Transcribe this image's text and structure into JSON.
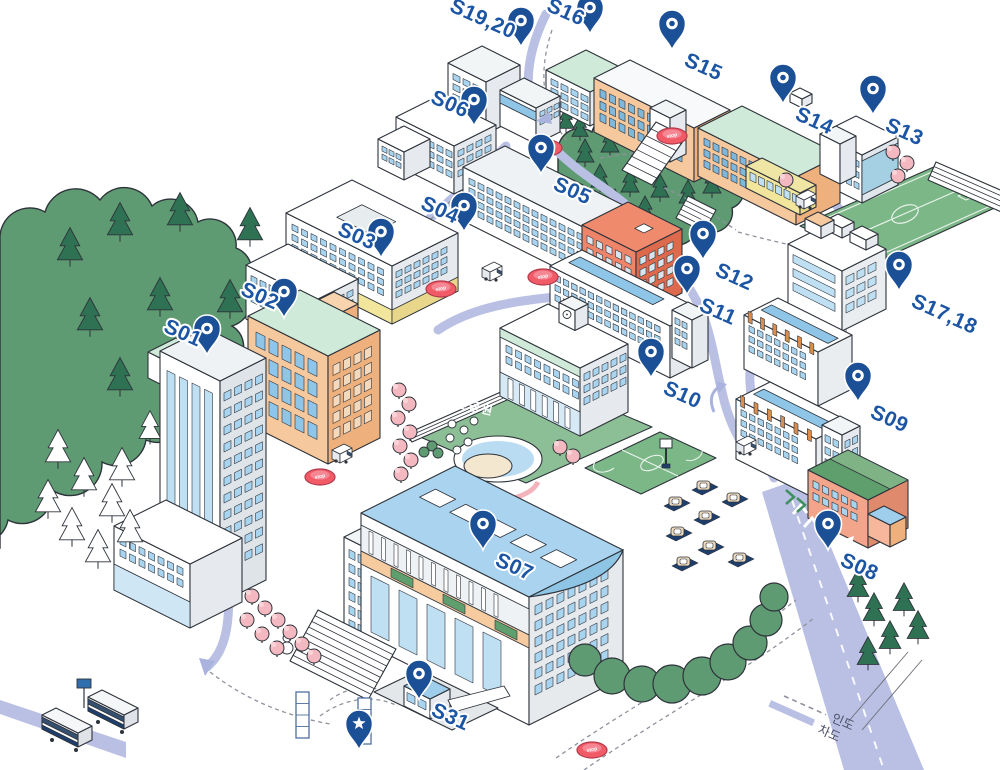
{
  "map": {
    "colors": {
      "pin": "#1b4f96",
      "label": "#1b55a4",
      "road": "#b9c0e4",
      "path": "#8d929c",
      "forest": "#5f9b72",
      "field": "#7cb788",
      "stop_disc": "#f15b67"
    },
    "legend": {
      "walkway_label": "인도",
      "roadway_label": "차도"
    },
    "park_label": "뉴턴공원",
    "stop_label": "stop",
    "markers": [
      {
        "id": "s01",
        "label": "S01",
        "x": 207,
        "y": 355,
        "side": "left"
      },
      {
        "id": "s02",
        "label": "S02",
        "x": 284,
        "y": 318,
        "side": "left"
      },
      {
        "id": "s03",
        "label": "S03",
        "x": 381,
        "y": 258,
        "side": "left"
      },
      {
        "id": "s04",
        "label": "S04",
        "x": 464,
        "y": 232,
        "side": "left"
      },
      {
        "id": "s05",
        "label": "S05",
        "x": 541,
        "y": 174,
        "side": "right"
      },
      {
        "id": "s06",
        "label": "S06",
        "x": 474,
        "y": 126,
        "side": "left"
      },
      {
        "id": "s07",
        "label": "S07",
        "x": 483,
        "y": 550,
        "side": "right"
      },
      {
        "id": "s08",
        "label": "S08",
        "x": 828,
        "y": 550,
        "side": "right"
      },
      {
        "id": "s09",
        "label": "S09",
        "x": 858,
        "y": 402,
        "side": "right"
      },
      {
        "id": "s10",
        "label": "S10",
        "x": 651,
        "y": 378,
        "side": "right"
      },
      {
        "id": "s11",
        "label": "S11",
        "x": 687,
        "y": 295,
        "side": "right"
      },
      {
        "id": "s12",
        "label": "S12",
        "x": 703,
        "y": 260,
        "side": "right"
      },
      {
        "id": "s13",
        "label": "S13",
        "x": 873,
        "y": 115,
        "side": "right"
      },
      {
        "id": "s14",
        "label": "S14",
        "x": 783,
        "y": 104,
        "side": "right"
      },
      {
        "id": "s15",
        "label": "S15",
        "x": 672,
        "y": 50,
        "side": "right"
      },
      {
        "id": "s16",
        "label": "S16",
        "x": 590,
        "y": 34,
        "side": "left"
      },
      {
        "id": "s17-18",
        "label": "S17,18",
        "x": 899,
        "y": 291,
        "side": "right"
      },
      {
        "id": "s19-20",
        "label": "S19,20",
        "x": 521,
        "y": 47,
        "side": "left"
      },
      {
        "id": "s31",
        "label": "S31",
        "x": 419,
        "y": 700,
        "side": "right"
      }
    ],
    "start_marker": {
      "id": "start",
      "icon": "star-pin",
      "x": 359,
      "y": 750
    }
  }
}
